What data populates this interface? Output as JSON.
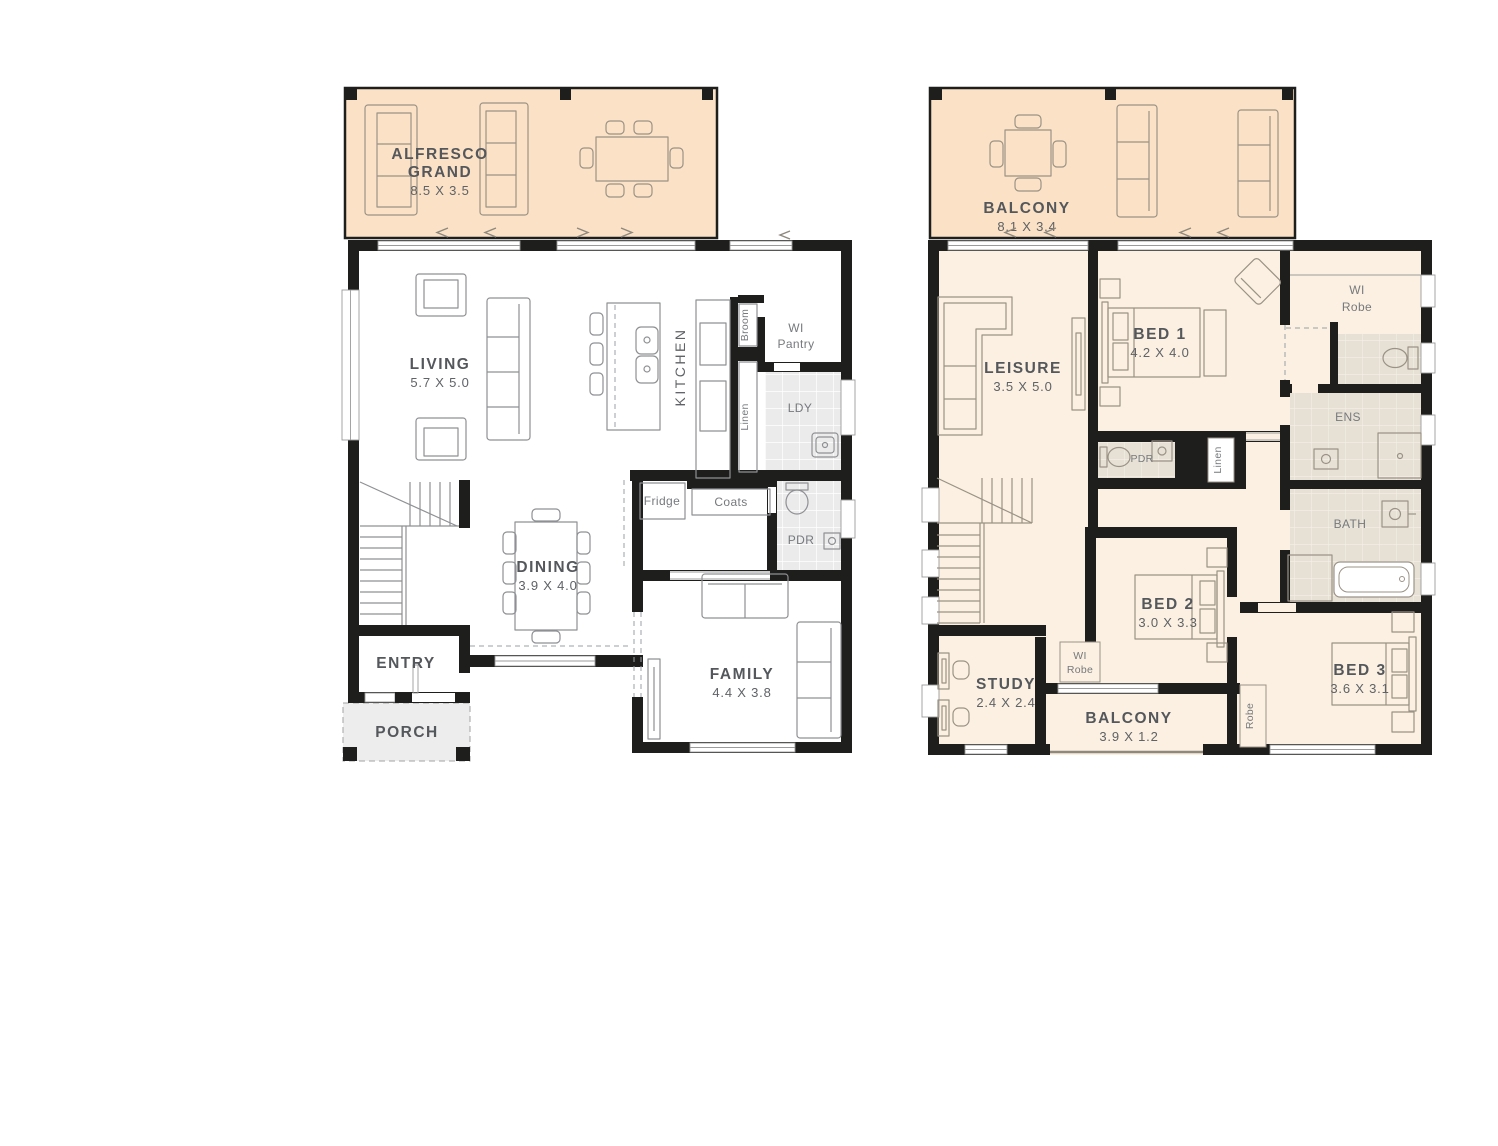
{
  "document": {
    "type": "two-storey house floor plan"
  },
  "colors": {
    "wall": "#1e1e1c",
    "outdoor_fill": "#fbe2c6",
    "upper_floor_fill": "#fbf0e1",
    "ground_tile": "#ebebeb",
    "upper_tile": "#e7e1d5",
    "porch_fill": "#ededed",
    "furniture_line_ground": "#8f9094",
    "furniture_line_upper": "#9b9286",
    "label_dark": "#54575b",
    "label_light": "#76797d"
  },
  "ground_floor": {
    "alfresco": {
      "line1": "ALFRESCO",
      "line2": "GRAND",
      "dims": "8.5 X 3.5"
    },
    "living": {
      "name": "LIVING",
      "dims": "5.7 X 5.0"
    },
    "kitchen": {
      "name": "KITCHEN"
    },
    "wi_pantry": {
      "line1": "WI",
      "line2": "Pantry"
    },
    "broom": {
      "label": "Broom"
    },
    "linen": {
      "label": "Linen"
    },
    "laundry": {
      "label": "LDY"
    },
    "fridge": {
      "label": "Fridge"
    },
    "coats": {
      "label": "Coats"
    },
    "powder": {
      "label": "PDR"
    },
    "dining": {
      "name": "DINING",
      "dims": "3.9 X 4.0"
    },
    "entry": {
      "name": "ENTRY"
    },
    "porch": {
      "name": "PORCH"
    },
    "family": {
      "name": "FAMILY",
      "dims": "4.4 X 3.8"
    }
  },
  "upper_floor": {
    "balcony": {
      "name": "BALCONY",
      "dims": "8.1 X 3.4"
    },
    "leisure": {
      "name": "LEISURE",
      "dims": "3.5 X 5.0"
    },
    "bed1": {
      "name": "BED 1",
      "dims": "4.2 X 4.0"
    },
    "wi_robe_main": {
      "line1": "WI",
      "line2": "Robe"
    },
    "ens": {
      "label": "ENS"
    },
    "bath": {
      "label": "BATH"
    },
    "powder": {
      "label": "PDR"
    },
    "linen": {
      "label": "Linen"
    },
    "bed2": {
      "name": "BED 2",
      "dims": "3.0 X 3.3"
    },
    "wi_robe_2": {
      "line1": "WI",
      "line2": "Robe"
    },
    "study": {
      "name": "STUDY",
      "dims": "2.4 X 2.4"
    },
    "balcony_rear": {
      "name": "BALCONY",
      "dims": "3.9 X 1.2"
    },
    "robe": {
      "label": "Robe"
    },
    "bed3": {
      "name": "BED 3",
      "dims": "3.6 X 3.1"
    }
  }
}
